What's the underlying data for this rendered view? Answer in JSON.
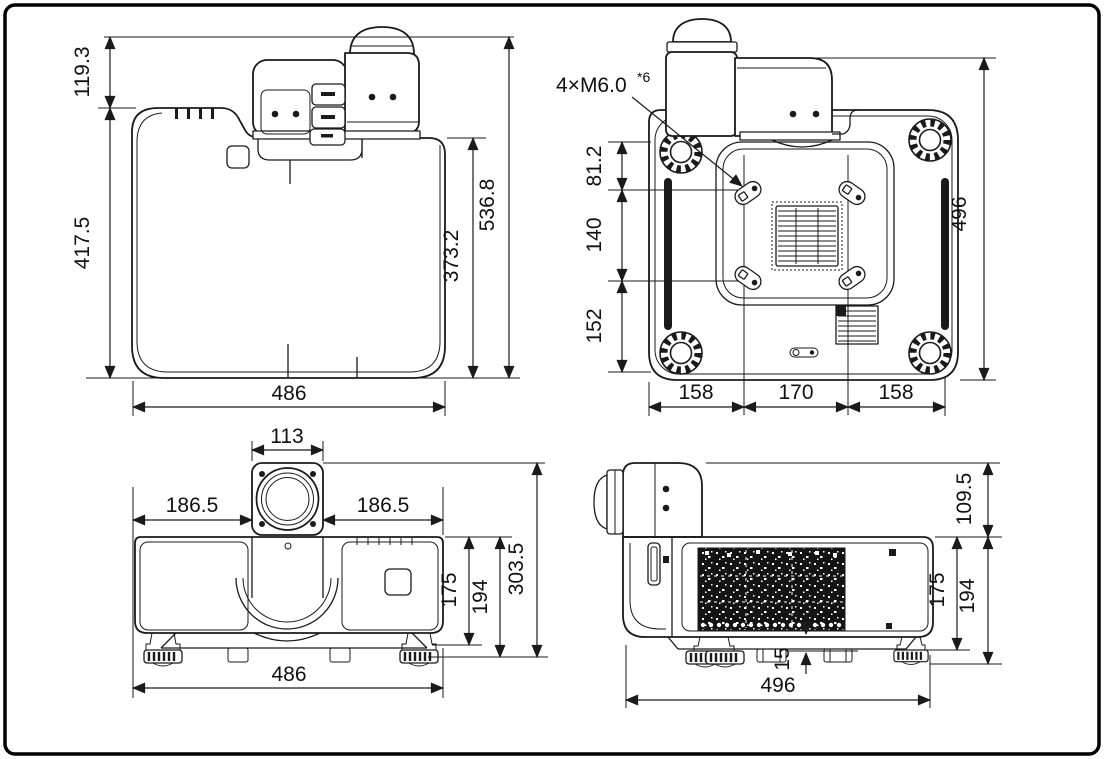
{
  "figure": {
    "type": "technical-dimension-drawing",
    "subject": "projector outline drawing (top, bottom, front, side views)",
    "line_color": "#1a1a1a",
    "background": "#ffffff"
  },
  "views": {
    "top": {
      "label": "top view",
      "dims": {
        "lens_protrusion": "119.3",
        "body_depth": "417.5",
        "overall_depth": "536.8",
        "rear_depth": "373.2",
        "width": "486"
      }
    },
    "bottom": {
      "label": "bottom view",
      "screw_note": {
        "text": "4×M6.0",
        "superscript": "*6"
      },
      "dims": {
        "front_to_screws": "81.2",
        "screw_spacing_depth": "140",
        "screws_to_rear": "152",
        "overall_depth": "496",
        "left_section": "158",
        "screw_spacing_width": "170",
        "right_section": "158"
      }
    },
    "front": {
      "label": "front view",
      "dims": {
        "lens_width": "113",
        "left_of_lens": "186.5",
        "right_of_lens": "186.5",
        "body_height": "175",
        "height_with_feet": "194",
        "overall_height": "303.5",
        "width": "486"
      }
    },
    "side": {
      "label": "side view",
      "dims": {
        "lens_rise": "109.5",
        "body_height": "175",
        "height_with_feet": "194",
        "foot_height": "15",
        "depth": "496"
      }
    }
  }
}
